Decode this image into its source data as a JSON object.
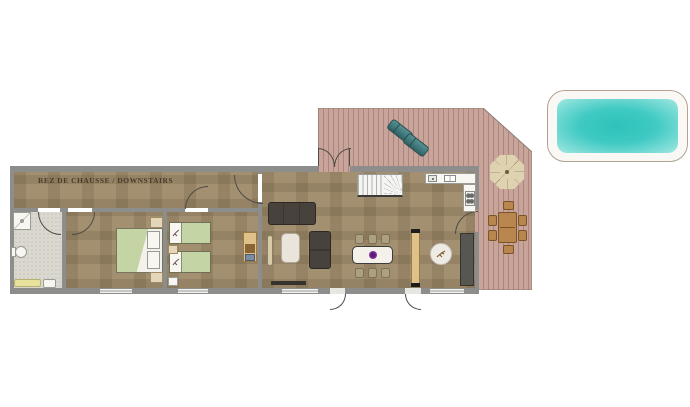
{
  "plan": {
    "label": "REZ DE CHAUSSE / DOWNSTAIRS"
  },
  "rooms": [
    "hallway",
    "bathroom",
    "double-bedroom",
    "twin-bedroom",
    "living-dining-kitchen",
    "terrace",
    "pool"
  ],
  "objects": [
    "shower",
    "toilet",
    "bath-mat",
    "double-bed",
    "nightstand",
    "single-bed",
    "desk",
    "laptop",
    "radiator",
    "sofa",
    "armchair",
    "tv-console",
    "dining-table",
    "dining-chair",
    "fruit-bowl",
    "sideboard",
    "round-rug",
    "tall-cabinet",
    "staircase",
    "kitchen-counter",
    "sink",
    "stove",
    "sun-lounger",
    "parasol",
    "outdoor-table",
    "outdoor-chair",
    "swimming-pool"
  ],
  "colors": {
    "floor-tan": "#a39070",
    "bathroom-floor": "#dad8cf",
    "wall-gray": "#8d8d8b",
    "terrace-pink": "#c9a49b",
    "terrace-stripe": "#9c7a6f",
    "pool-water": "#2ec2bb",
    "pool-water-edge": "#a5e7e2",
    "pool-deck": "#faf8f4",
    "bed-green": "#c5d4a4",
    "wood-light": "#dec289",
    "wood-outdoor": "#b8864e",
    "sofa-dark": "#48423c",
    "lounger-teal": "#417a7d",
    "parasol-beige": "#ded2b0",
    "accent-purple": "#8a3aa0",
    "label-brown": "#4a3b2a"
  }
}
